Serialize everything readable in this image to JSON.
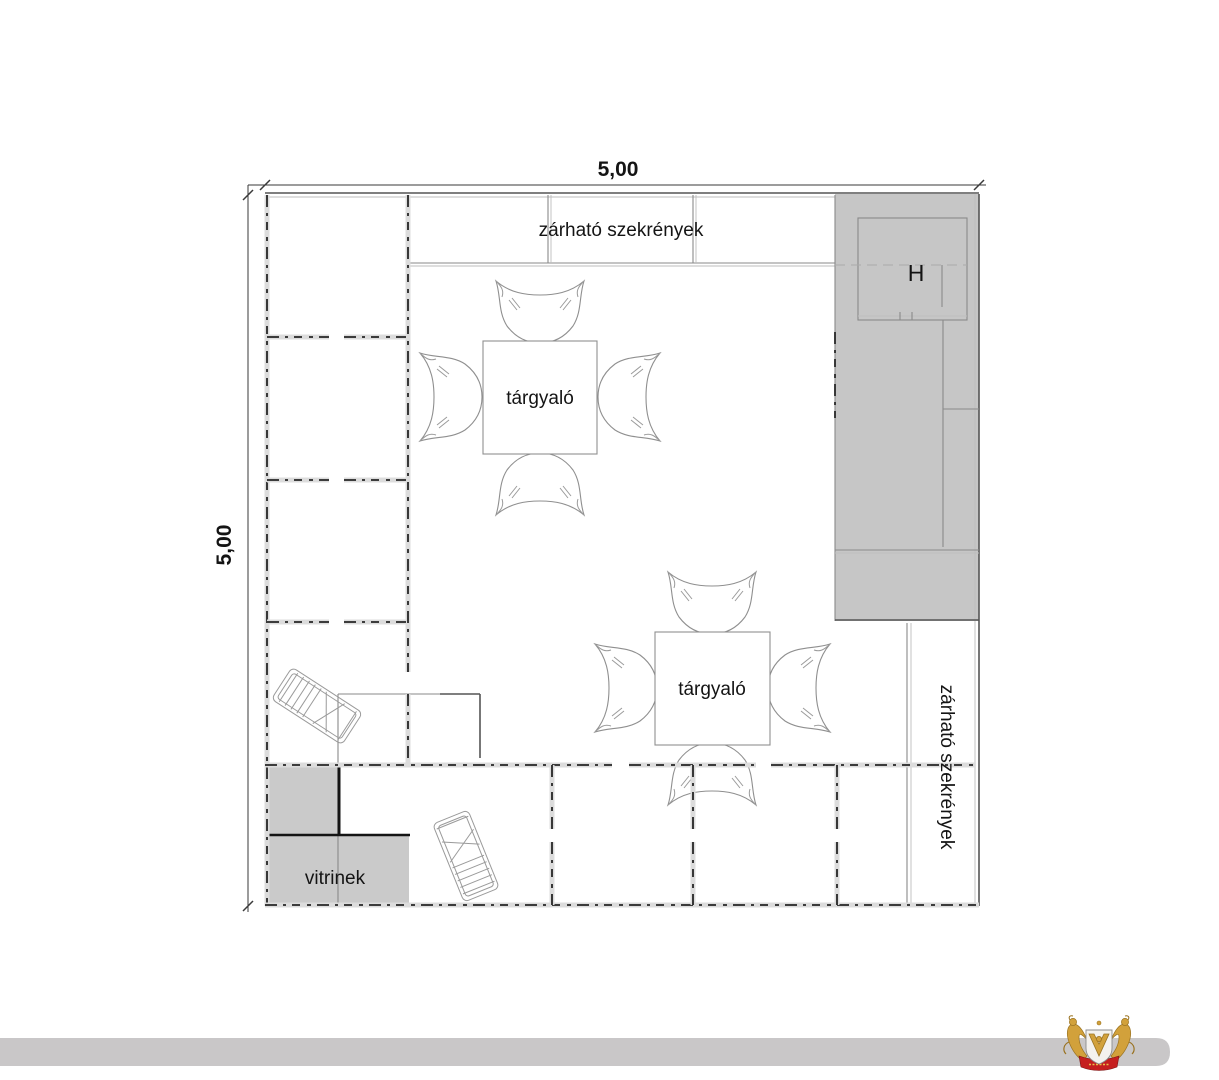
{
  "plan": {
    "dimension_top": "5,00",
    "dimension_left": "5,00",
    "top_cabinets_label": "zárható szekrények",
    "right_cabinets_label": "zárható szekrények",
    "meeting_table_1_label": "tárgyaló",
    "meeting_table_2_label": "tárgyaló",
    "display_cases_label": "vitrinek",
    "utility_room_label": "H"
  },
  "colors": {
    "block_gray": "#c6c6c6",
    "vitrine_gray": "#cacaca",
    "room_white": "#ffffff",
    "footer_bar": "#c9c7c8",
    "logo_gold": "#d2a13b",
    "logo_gold_dark": "#9a7322",
    "logo_red": "#c51f1f",
    "logo_shield": "#f4f2ee"
  }
}
